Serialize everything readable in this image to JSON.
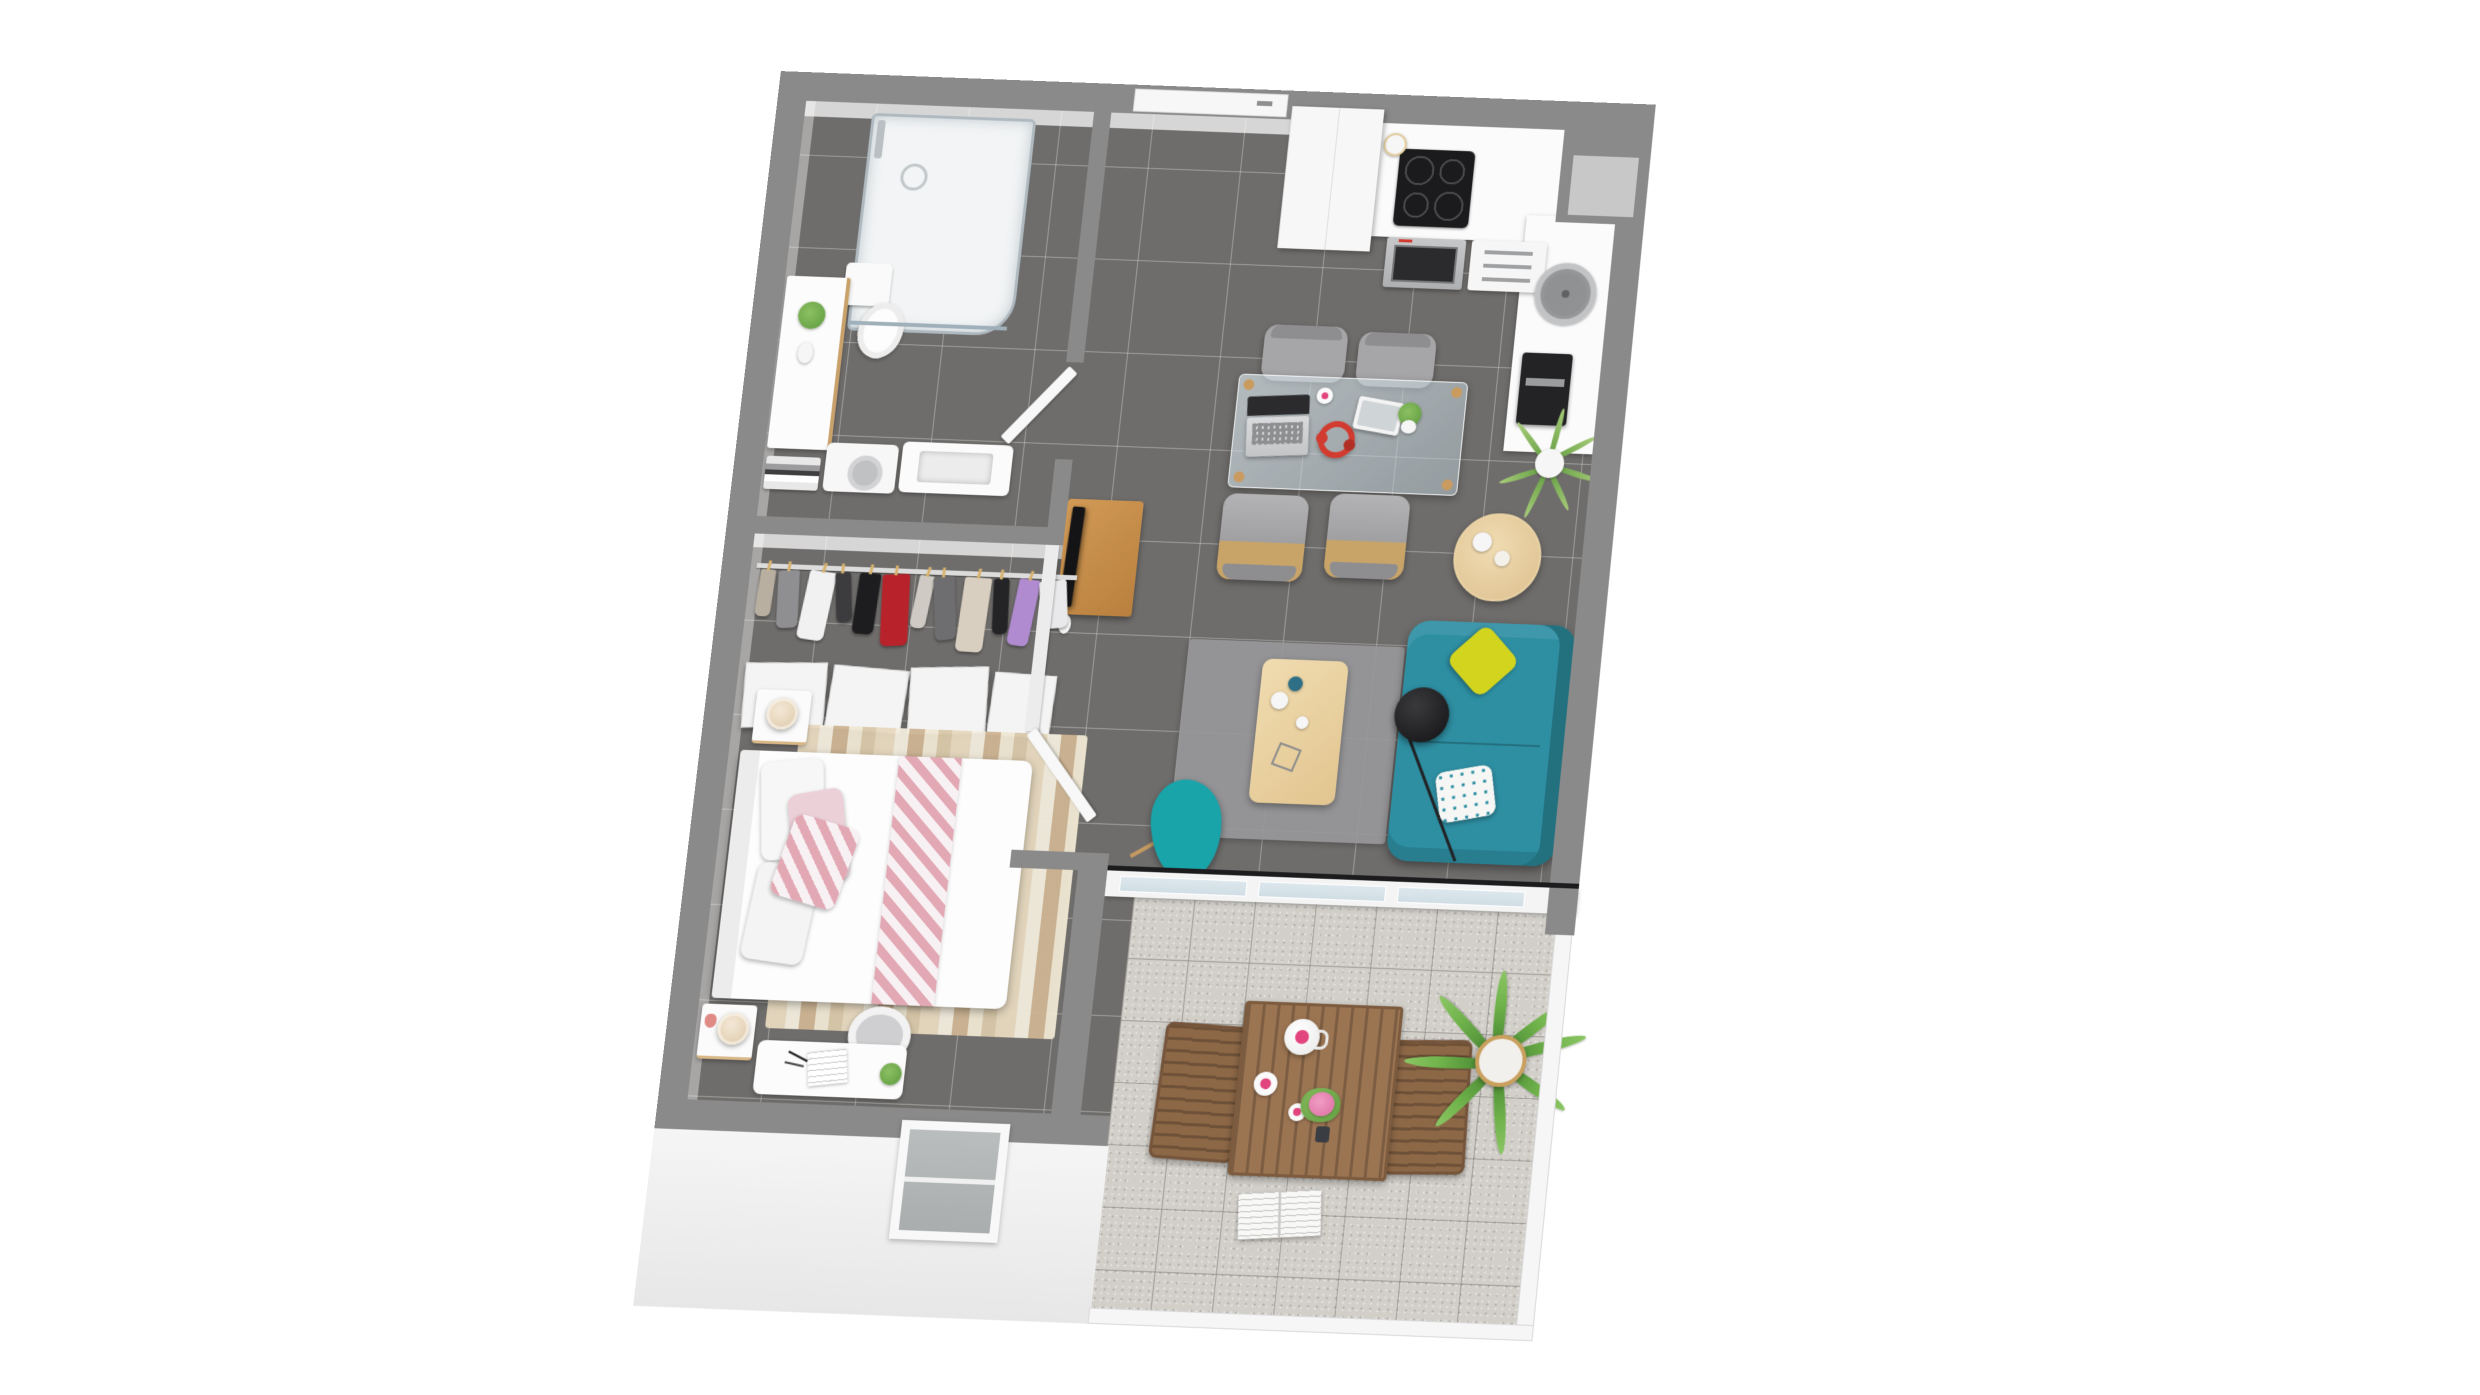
{
  "scene": {
    "title": "3D top-down floor plan render - one-bedroom apartment with balcony",
    "style": "photorealistic dollhouse view, no text labels visible",
    "background": "#ffffff"
  },
  "palette": {
    "bg": "#ffffff",
    "wall": "#8a8a8a",
    "floor": "#6f6d6b",
    "balconyFloor": "#d2cfc9",
    "facade": "#f3f3f3",
    "teal": "#2e8fa3",
    "tealChair": "#19a4aa",
    "yellow": "#d3d41e",
    "pinkChevron": "#e2a8b4",
    "pinkHot": "#e2447e",
    "red": "#d23b2f",
    "wood": "#d7b37c",
    "outdoorWood": "#9b7452",
    "green": "#6fae4e",
    "black": "#1b1b1d",
    "stainless": "#b9babc"
  },
  "rooms": {
    "bathroom": {
      "name": "Bathroom",
      "items": [
        "walk-in shower with glass enclosure",
        "toilet",
        "vanity cabinet with green plant",
        "towel shelf",
        "washing machine",
        "washbasin unit",
        "door ajar"
      ]
    },
    "hallway": {
      "name": "Entry hallway",
      "items": [
        "entry door with handle",
        "dark gray tile floor"
      ]
    },
    "kitchen": {
      "name": "Kitchen",
      "items": [
        "tall cabinet",
        "induction cooktop with 4 burners",
        "built-in oven with red display",
        "drawer unit",
        "paper towel holder",
        "L-shaped white worktop",
        "round stainless sink",
        "black coffee machine",
        "corner shaft with upper cabinet",
        "spiky plant on wire stand"
      ]
    },
    "dining": {
      "name": "Dining area",
      "items": [
        "glass dining table with wood legs",
        "four gray dining chairs",
        "open laptop",
        "tablet",
        "white mug",
        "red headphones",
        "small potted plant"
      ]
    },
    "living": {
      "name": "Living room",
      "items": [
        "teal two-seat sofa",
        "yellow cushion",
        "teal dotted cushion",
        "black arc floor lamp",
        "light wood coffee table with vases",
        "gray rug",
        "teal butterfly chair",
        "round wood side table with white vases",
        "TV on wood console",
        "white partition",
        "bedroom door ajar",
        "glazed window wall to balcony"
      ]
    },
    "dressing": {
      "name": "Dressing corridor",
      "items": [
        "clothes rail with wooden hangers",
        "hanging garments",
        "white storage panels"
      ],
      "clothes_colors": [
        "#b9afa0",
        "#8f8f91",
        "#f1f1f1",
        "#3c3c3e",
        "#1d1d1f",
        "#b8232b",
        "#cfcbc4",
        "#6e6e70",
        "#d9cfc0",
        "#242426",
        "#b08bd0",
        "#e9e9eb"
      ]
    },
    "bedroom": {
      "name": "Bedroom",
      "items": [
        "double bed with white duvet",
        "pink chevron runner",
        "white and pink pillows",
        "chevron cushion",
        "striped beige rug",
        "two white nightstands",
        "two cream table lamps",
        "pink pineapple ornament",
        "white desk with notebook and pens",
        "desk plant",
        "white shell chair",
        "facade window"
      ]
    },
    "balcony": {
      "name": "Balcony terrace",
      "items": [
        "slatted wood outdoor table",
        "two wood outdoor armchairs",
        "white teapot with pink lid",
        "cup and saucer",
        "second cup",
        "pink flower bouquet in dark vase",
        "open book on floor",
        "potted palm",
        "white railing with glass"
      ]
    }
  }
}
